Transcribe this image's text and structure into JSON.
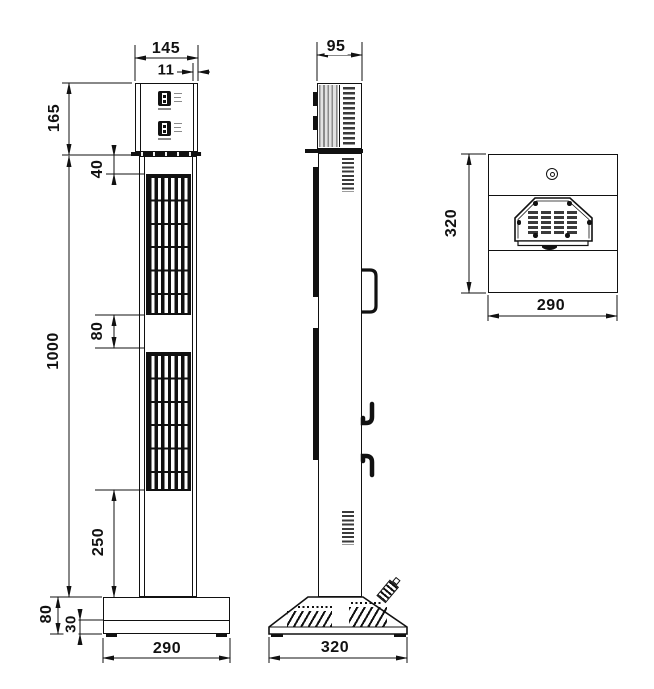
{
  "title": "tower-unit-dimension-drawing",
  "dims": {
    "front": {
      "top_width": "145",
      "top_inset": "11",
      "head_height": "165",
      "grille_offset": "40",
      "body_height": "1000",
      "grille_gap": "80",
      "lower_section": "250",
      "base_height": "80",
      "plinth_height": "30",
      "base_width": "290"
    },
    "side": {
      "top_depth": "95",
      "base_depth": "320"
    },
    "top": {
      "depth": "320",
      "width": "290"
    }
  },
  "colors": {
    "line": "#111111",
    "slot": "#3a3a3a",
    "stripe": "#8a8a8a"
  }
}
